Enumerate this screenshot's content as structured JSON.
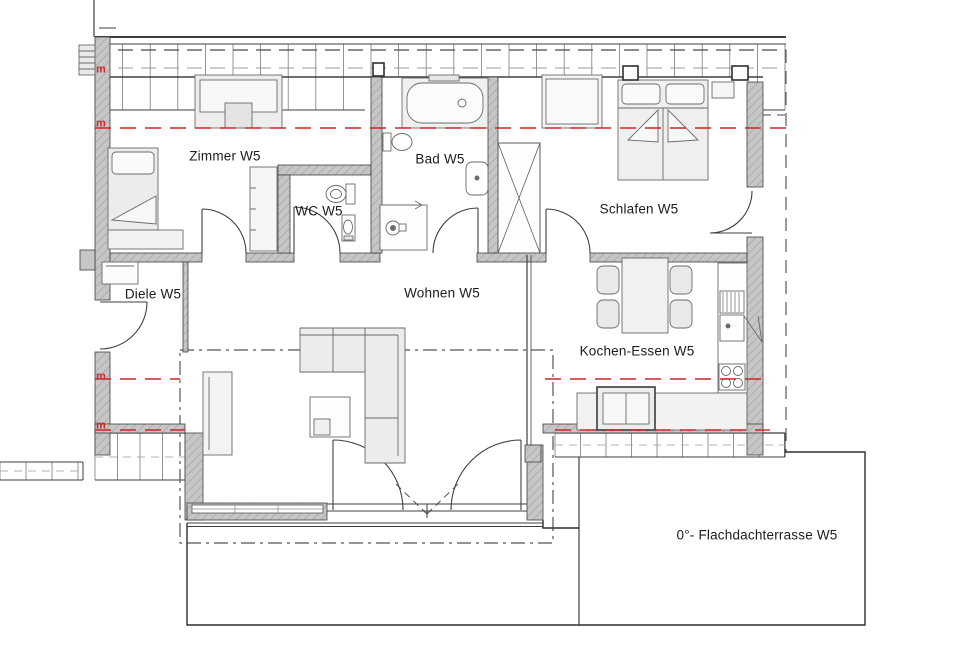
{
  "plan": {
    "title": "Grundriss Wohnung W5",
    "rooms": {
      "zimmer": {
        "label": "Zimmer W5"
      },
      "bad": {
        "label": "Bad W5"
      },
      "wc": {
        "label": "WC W5"
      },
      "schlafen": {
        "label": "Schlafen W5"
      },
      "diele": {
        "label": "Diele W5"
      },
      "wohnen": {
        "label": "Wohnen W5"
      },
      "kochen": {
        "label": "Kochen-Essen W5"
      },
      "terrasse": {
        "label": "0°- Flachdachterrasse W5"
      }
    },
    "markers": {
      "meter_label": "m"
    },
    "colors": {
      "red": "#cc2626",
      "wall": "#c6c6c6",
      "line": "#3f3f3f"
    }
  }
}
